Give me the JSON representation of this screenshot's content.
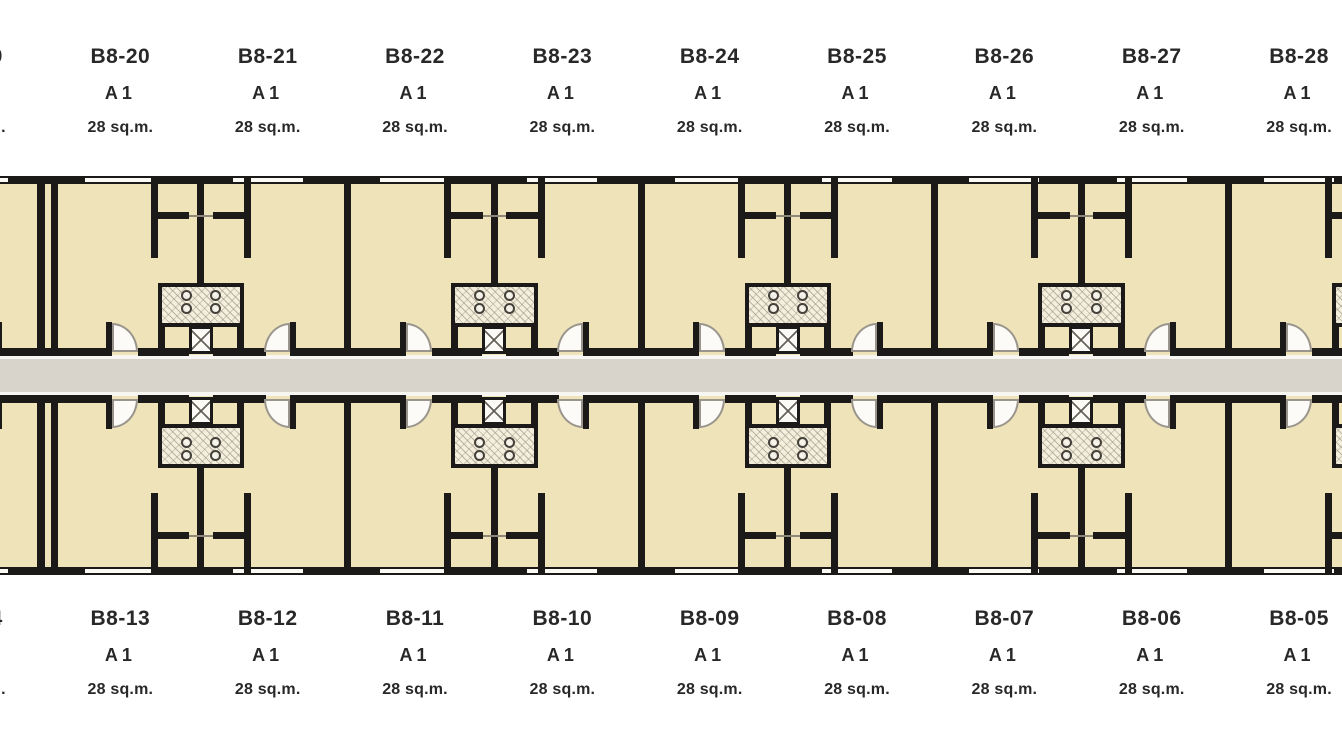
{
  "title": "Building B8 floor plan - unit layout",
  "unit_type_label": "A1",
  "unit_area_label": "28 sq.m.",
  "top_row": {
    "units": [
      {
        "code": "B8-19",
        "type": "A1",
        "area": "28 sq.m."
      },
      {
        "code": "B8-20",
        "type": "A1",
        "area": "28 sq.m."
      },
      {
        "code": "B8-21",
        "type": "A1",
        "area": "28 sq.m."
      },
      {
        "code": "B8-22",
        "type": "A1",
        "area": "28 sq.m."
      },
      {
        "code": "B8-23",
        "type": "A1",
        "area": "28 sq.m."
      },
      {
        "code": "B8-24",
        "type": "A1",
        "area": "28 sq.m."
      },
      {
        "code": "B8-25",
        "type": "A1",
        "area": "28 sq.m."
      },
      {
        "code": "B8-26",
        "type": "A1",
        "area": "28 sq.m."
      },
      {
        "code": "B8-27",
        "type": "A1",
        "area": "28 sq.m."
      },
      {
        "code": "B8-28",
        "type": "A1",
        "area": "28 sq.m."
      }
    ]
  },
  "bottom_row": {
    "units": [
      {
        "code": "B8-14",
        "type": "A1",
        "area": "28 sq.m."
      },
      {
        "code": "B8-13",
        "type": "A1",
        "area": "28 sq.m."
      },
      {
        "code": "B8-12",
        "type": "A1",
        "area": "28 sq.m."
      },
      {
        "code": "B8-11",
        "type": "A1",
        "area": "28 sq.m."
      },
      {
        "code": "B8-10",
        "type": "A1",
        "area": "28 sq.m."
      },
      {
        "code": "B8-09",
        "type": "A1",
        "area": "28 sq.m."
      },
      {
        "code": "B8-08",
        "type": "A1",
        "area": "28 sq.m."
      },
      {
        "code": "B8-07",
        "type": "A1",
        "area": "28 sq.m."
      },
      {
        "code": "B8-06",
        "type": "A1",
        "area": "28 sq.m."
      },
      {
        "code": "B8-05",
        "type": "A1",
        "area": "28 sq.m."
      }
    ]
  },
  "colors": {
    "background": "#ffffff",
    "unit_fill": "#efe3ba",
    "wall": "#1c1a18",
    "corridor": "#d8d4cb",
    "hatch_bg": "#f4eedd",
    "door_arc": "#9a958c",
    "thin_line": "#8c8779",
    "label_text": "#282828"
  }
}
